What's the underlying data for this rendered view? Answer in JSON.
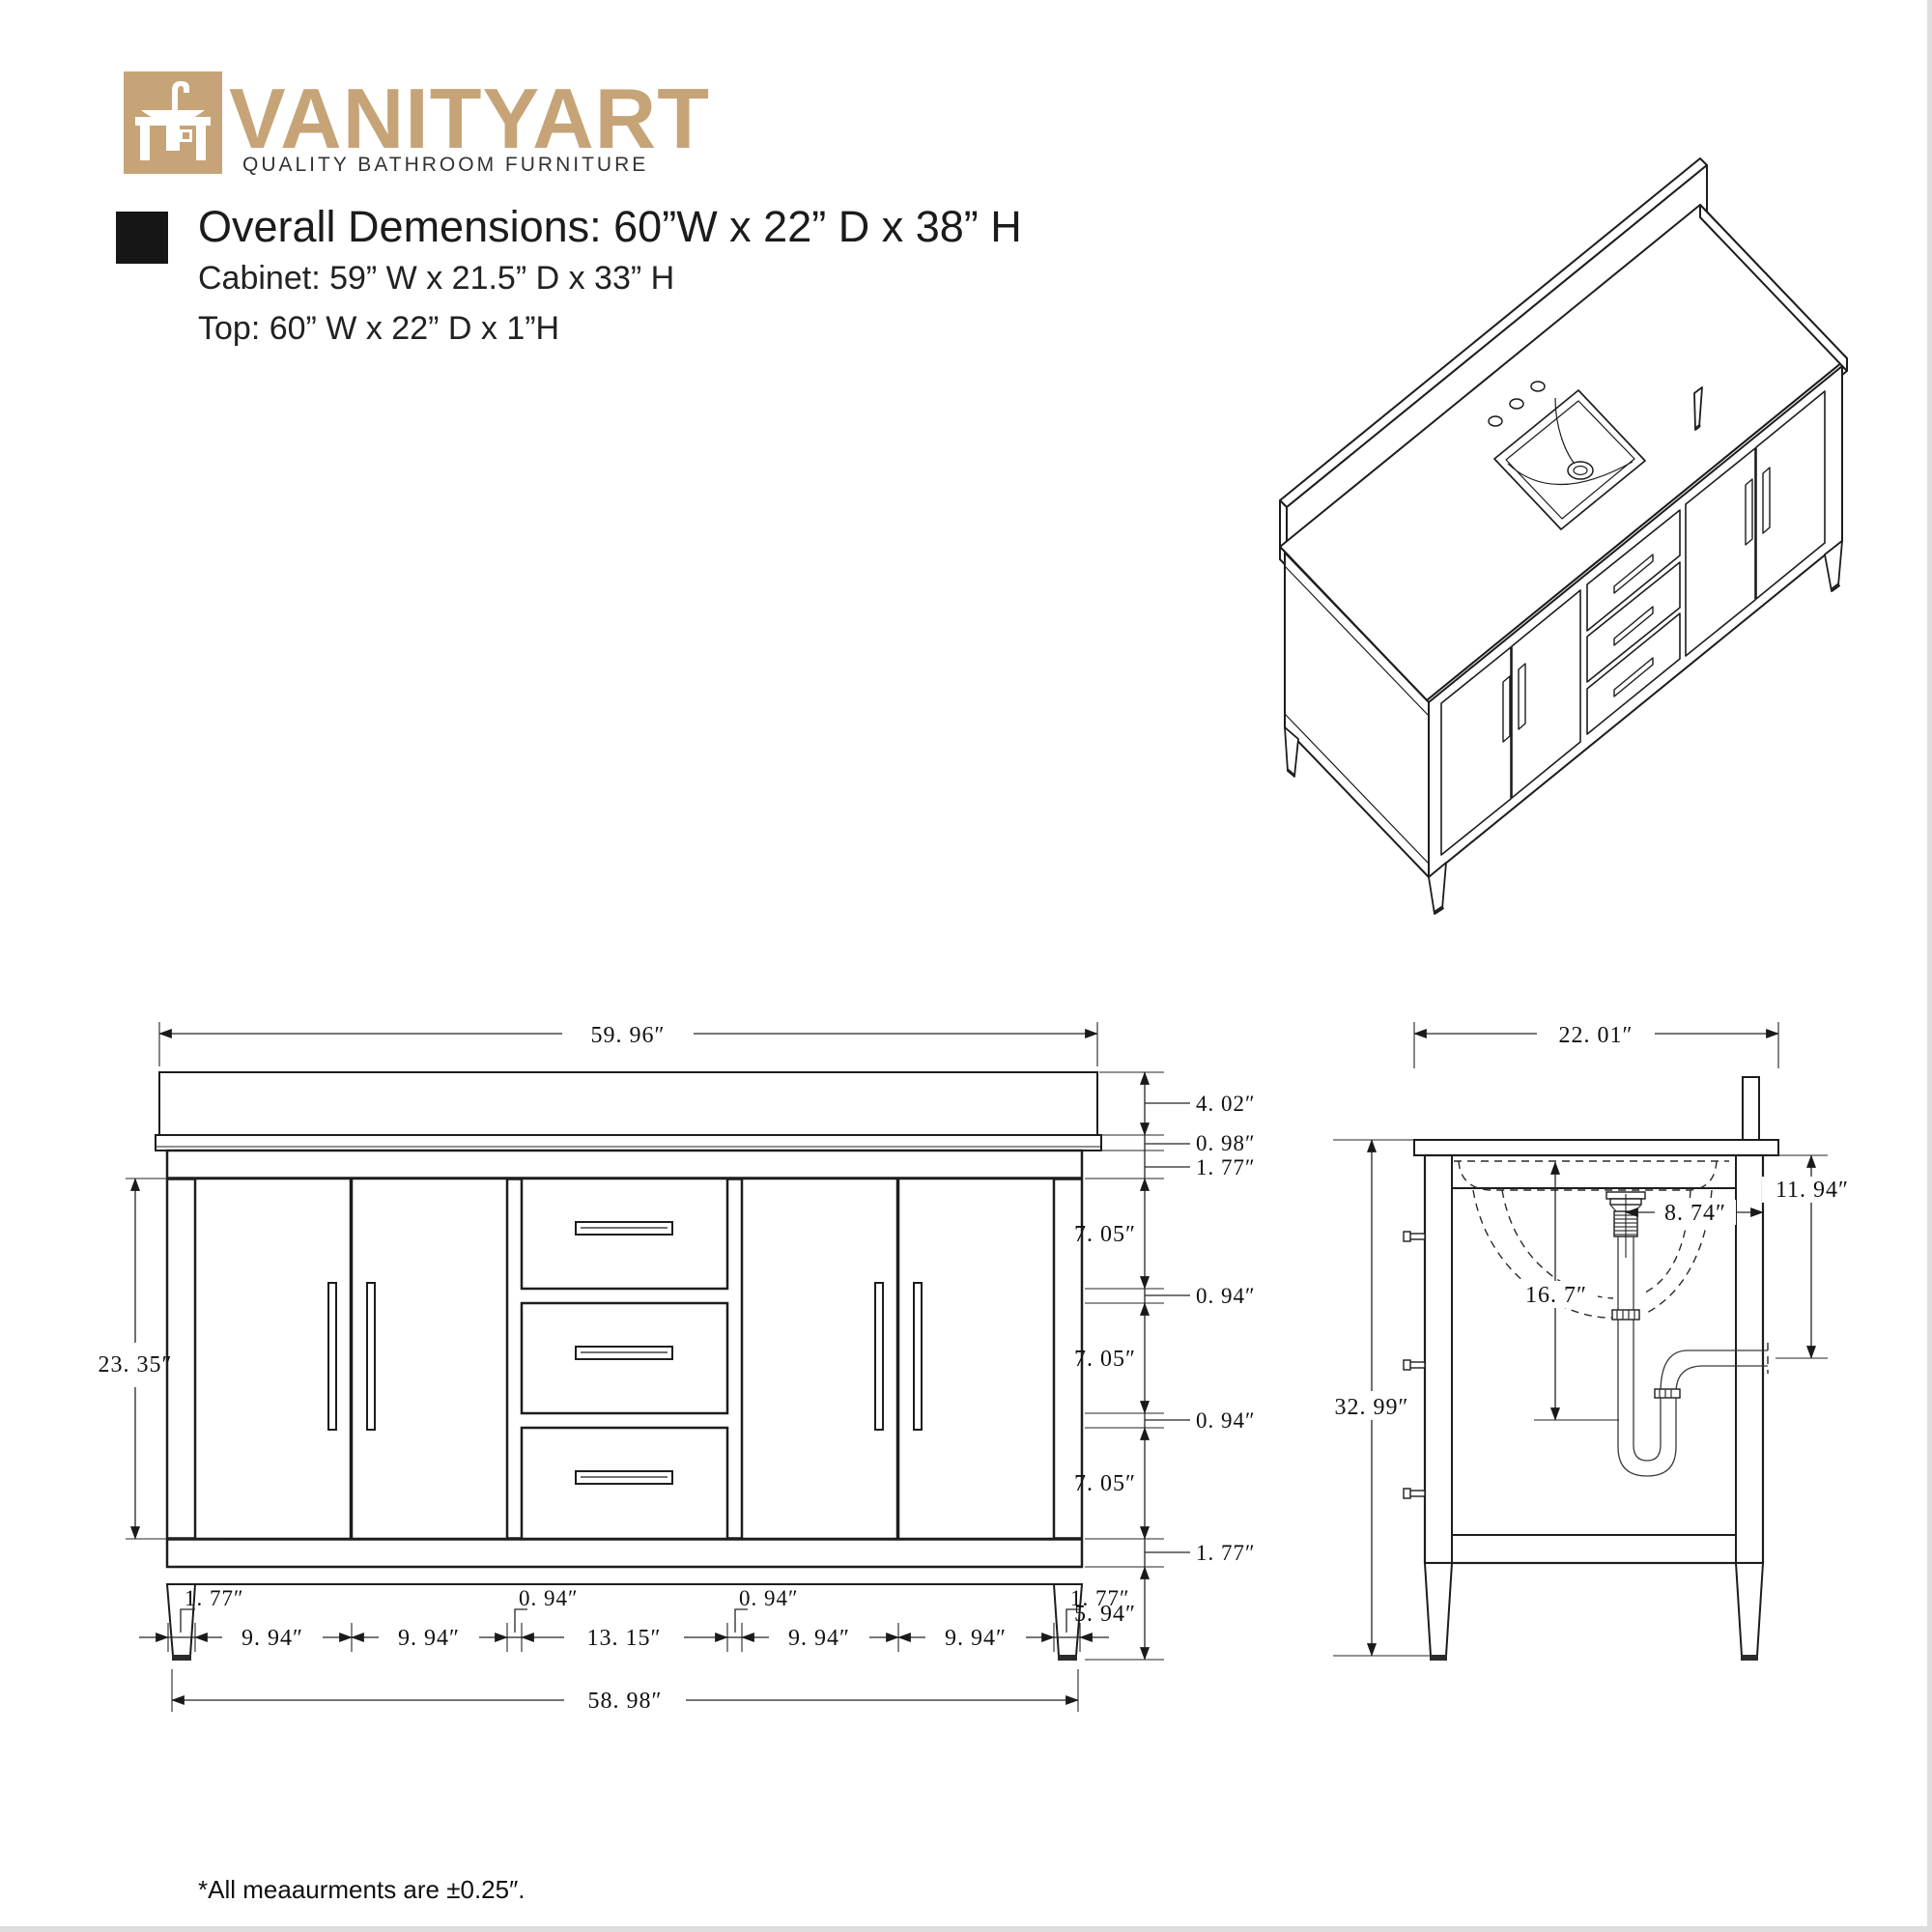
{
  "brand": {
    "name": "VANITYART",
    "tagline": "QUALITY BATHROOM FURNITURE",
    "accent_color": "#C6A477",
    "icon": "vanity-sink-icon"
  },
  "specs": {
    "overall": "Overall Demensions: 60”W x 22” D x 38” H",
    "cabinet": "Cabinet: 59” W x 21.5” D x 33” H",
    "top": "Top: 60” W x 22” D x 1”H"
  },
  "front": {
    "width_top": "59. 96″",
    "backsplash_h": "4. 02″",
    "counter_h": "0. 98″",
    "top_rail": "1. 77″",
    "drawer1_h": "7. 05″",
    "gap1_h": "0. 94″",
    "drawer2_h": "7. 05″",
    "gap2_h": "0. 94″",
    "drawer3_h": "7. 05″",
    "bottom_rail": "1. 77″",
    "leg_h": "5. 94″",
    "door_region_h": "23. 35″",
    "left_stile": "1. 77″",
    "door1_w": "9. 94″",
    "door2_w": "9. 94″",
    "left_divider": "0. 94″",
    "drawer_w": "13. 15″",
    "right_divider": "0. 94″",
    "door3_w": "9. 94″",
    "door4_w": "9. 94″",
    "right_stile": "1. 77″",
    "width_bottom": "58. 98″"
  },
  "side": {
    "depth_top": "22. 01″",
    "height": "32. 99″",
    "drain_offset": "8. 74″",
    "drain_depth": "16. 7″",
    "outlet_h": "11. 94″"
  },
  "footnote": "*All meaaurments are ±0.25″."
}
